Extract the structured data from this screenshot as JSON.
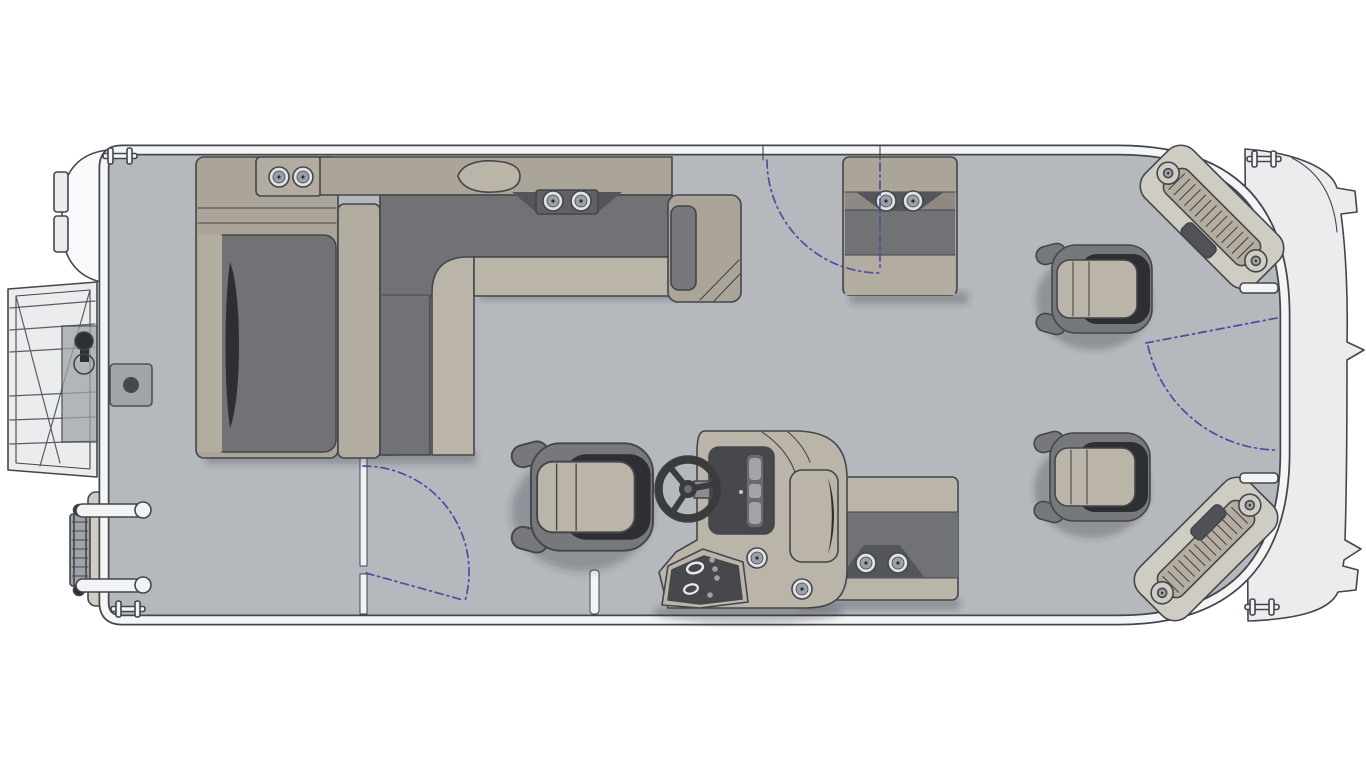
{
  "figure": {
    "type": "pontoon-boat-floor-plan",
    "view": "overhead",
    "bow_direction": "right",
    "stern_direction": "left",
    "background": "#ffffff"
  },
  "palette": {
    "deck": "#b5b8bd",
    "hullRail": "#f4f5f6",
    "outline": "#43464b",
    "tanBase": "#aaa499",
    "tanMid": "#b3aca0",
    "tanLight": "#bbb4a8",
    "cushionDark": "#717276",
    "shellDark": "#77787c",
    "darkest": "#2e2f32",
    "panelDark": "#47484c",
    "cream": "#cfccc4",
    "tread": "#b5aea0",
    "metal": "#9fa3a8",
    "motorWhite": "#f8f9fa",
    "nose": "#ebeced",
    "accentBlue": "#4b4f9f",
    "shadow": "rgba(45,48,53,0.28)"
  },
  "components": {
    "stern_exterior": [
      "outboard-motor",
      "swim-platform",
      "platform-bracket",
      "ski-tow-knob",
      "boarding-ladder",
      "transom-bracket",
      "grab-handle-x2"
    ],
    "aft_deck": [
      "fuel-door",
      "aft-partition-gate"
    ],
    "port_lounge_group": {
      "parts": [
        "corner-cup-console",
        "aft-facing-lounge",
        "divider-backrest",
        "l-shaped-lounge",
        "cup-holder-tray",
        "armrest-end-cap"
      ],
      "cup_holders": 4
    },
    "benches": [
      {
        "name": "port-bow-bench",
        "cup_holders": 2
      },
      {
        "name": "midship-bench",
        "cup_holders": 2
      }
    ],
    "helm_station": {
      "parts": [
        "console-body",
        "instrument-panel",
        "gauge-cluster",
        "steering-wheel",
        "switch-panel",
        "side-pod"
      ],
      "cup_holders": 2
    },
    "chairs": [
      "captain-chair",
      "bow-chair-upper",
      "bow-chair-lower"
    ],
    "bow": [
      "bow-corner-step-upper",
      "bow-corner-step-lower",
      "bow-nose"
    ],
    "gates": [
      "aft-partition-gate",
      "port-side-gate",
      "bow-gate"
    ],
    "gate_swing_arcs": 3,
    "cleats": 4,
    "cup_holders_total": 10
  }
}
